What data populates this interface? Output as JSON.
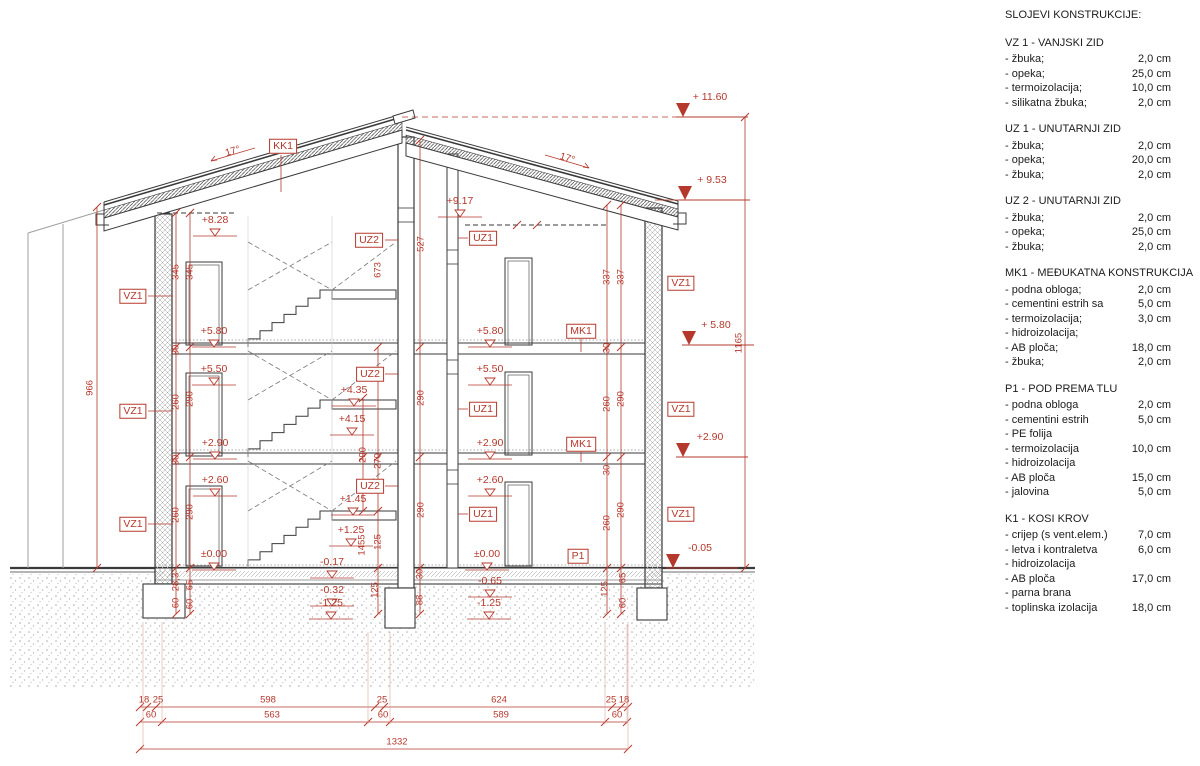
{
  "colors": {
    "accent_red": "#b5382c",
    "line_dark": "#3a3a3a"
  },
  "legend": {
    "title": "SLOJEVI KONSTRUKCIJE:",
    "sections": [
      {
        "heading": "VZ 1 - VANJSKI ZID",
        "items": [
          [
            "- žbuka;",
            "2,0 cm"
          ],
          [
            "- opeka;",
            "25,0 cm"
          ],
          [
            "- termoizolacija;",
            "10,0 cm"
          ],
          [
            "- silikatna žbuka;",
            "2,0 cm"
          ]
        ]
      },
      {
        "heading": "UZ 1 - UNUTARNJI ZID",
        "items": [
          [
            "- žbuka;",
            "2,0 cm"
          ],
          [
            "- opeka;",
            "20,0 cm"
          ],
          [
            "- žbuka;",
            "2,0 cm"
          ]
        ]
      },
      {
        "heading": "UZ 2 - UNUTARNJI ZID",
        "items": [
          [
            "- žbuka;",
            "2,0 cm"
          ],
          [
            "- opeka;",
            "25,0 cm"
          ],
          [
            "- žbuka;",
            "2,0 cm"
          ]
        ]
      },
      {
        "heading": "MK1 - MEĐUKATNA KONSTRUKCIJA",
        "items": [
          [
            "- podna obloga;",
            "2,0 cm"
          ],
          [
            "- cementini estrih sa",
            "5,0 cm"
          ],
          [
            "- termoizolacija;",
            "3,0 cm"
          ],
          [
            "- hidroizolacija;",
            ""
          ],
          [
            "- AB ploča;",
            "18,0 cm"
          ],
          [
            "- žbuka;",
            "2,0 cm"
          ]
        ]
      },
      {
        "heading": "P1 - POD PREMA TLU",
        "items": [
          [
            "- podna obloga",
            "2,0 cm"
          ],
          [
            "- cementini estrih",
            "5,0 cm"
          ],
          [
            "- PE folija",
            ""
          ],
          [
            "- termoizolacija",
            "10,0 cm"
          ],
          [
            "- hidroizolacija",
            ""
          ],
          [
            "- AB ploča",
            "15,0 cm"
          ],
          [
            "- jalovina",
            "5,0 cm"
          ]
        ]
      },
      {
        "heading": "K1 - KOSI KROV",
        "items": [
          [
            "- crijep (s vent.elem.)",
            "7,0 cm"
          ],
          [
            "- letva i kontraletva",
            "6,0 cm"
          ],
          [
            "- hidroizolacija",
            ""
          ],
          [
            "- AB ploča",
            "17,0 cm"
          ],
          [
            "- parna brana",
            ""
          ],
          [
            "- toplinska izolacija",
            "18,0 cm"
          ]
        ]
      }
    ]
  },
  "drawing": {
    "labels": [
      {
        "t": "KK1",
        "x": 283,
        "y": 146,
        "k": "box"
      },
      {
        "t": "UZ2",
        "x": 369,
        "y": 240,
        "k": "box"
      },
      {
        "t": "UZ1",
        "x": 483,
        "y": 238,
        "k": "box"
      },
      {
        "t": "VZ1",
        "x": 133,
        "y": 296,
        "k": "box"
      },
      {
        "t": "VZ1",
        "x": 681,
        "y": 283,
        "k": "box"
      },
      {
        "t": "MK1",
        "x": 581,
        "y": 331,
        "k": "box"
      },
      {
        "t": "UZ2",
        "x": 370,
        "y": 374,
        "k": "box"
      },
      {
        "t": "UZ1",
        "x": 483,
        "y": 409,
        "k": "box"
      },
      {
        "t": "VZ1",
        "x": 133,
        "y": 411,
        "k": "box"
      },
      {
        "t": "VZ1",
        "x": 681,
        "y": 409,
        "k": "box"
      },
      {
        "t": "MK1",
        "x": 581,
        "y": 444,
        "k": "box"
      },
      {
        "t": "UZ2",
        "x": 370,
        "y": 486,
        "k": "box"
      },
      {
        "t": "UZ1",
        "x": 483,
        "y": 514,
        "k": "box"
      },
      {
        "t": "VZ1",
        "x": 133,
        "y": 524,
        "k": "box"
      },
      {
        "t": "VZ1",
        "x": 681,
        "y": 514,
        "k": "box"
      },
      {
        "t": "P1",
        "x": 578,
        "y": 556,
        "k": "box"
      },
      {
        "t": "+8.28",
        "x": 215,
        "y": 220,
        "k": "eo"
      },
      {
        "t": "+9.17",
        "x": 460,
        "y": 201,
        "k": "eo"
      },
      {
        "t": "+5.80",
        "x": 214,
        "y": 331,
        "k": "eo"
      },
      {
        "t": "+5.50",
        "x": 214,
        "y": 369,
        "k": "eo"
      },
      {
        "t": "+2.90",
        "x": 215,
        "y": 443,
        "k": "eo"
      },
      {
        "t": "+2.60",
        "x": 215,
        "y": 480,
        "k": "eo"
      },
      {
        "t": "±0.00",
        "x": 214,
        "y": 554,
        "k": "eo"
      },
      {
        "t": "+5.80",
        "x": 490,
        "y": 331,
        "k": "eo"
      },
      {
        "t": "+5.50",
        "x": 490,
        "y": 369,
        "k": "eo"
      },
      {
        "t": "+2.90",
        "x": 490,
        "y": 443,
        "k": "eo"
      },
      {
        "t": "+2.60",
        "x": 490,
        "y": 480,
        "k": "eo"
      },
      {
        "t": "±0.00",
        "x": 487,
        "y": 554,
        "k": "eo"
      },
      {
        "t": "+4.35",
        "x": 354,
        "y": 390,
        "k": "eo"
      },
      {
        "t": "+4.15",
        "x": 352,
        "y": 419,
        "k": "eo"
      },
      {
        "t": "+1.45",
        "x": 353,
        "y": 499,
        "k": "eo"
      },
      {
        "t": "+1.25",
        "x": 351,
        "y": 530,
        "k": "eo"
      },
      {
        "t": "-0.17",
        "x": 332,
        "y": 562,
        "k": "eo"
      },
      {
        "t": "-0.32",
        "x": 332,
        "y": 590,
        "k": "eo"
      },
      {
        "t": "-1.25",
        "x": 331,
        "y": 603,
        "k": "eo"
      },
      {
        "t": "-0.65",
        "x": 490,
        "y": 581,
        "k": "eo"
      },
      {
        "t": "-1.25",
        "x": 489,
        "y": 603,
        "k": "eo"
      },
      {
        "t": "+ 11.60",
        "x": 710,
        "y": 97,
        "k": "ef"
      },
      {
        "t": "+ 9.53",
        "x": 712,
        "y": 180,
        "k": "ef"
      },
      {
        "t": "+ 5.80",
        "x": 716,
        "y": 325,
        "k": "ef"
      },
      {
        "t": "+2.90",
        "x": 710,
        "y": 437,
        "k": "ef"
      },
      {
        "t": "-0.05",
        "x": 700,
        "y": 548,
        "k": "ef"
      },
      {
        "t": "966",
        "x": 90,
        "y": 388,
        "k": "dv"
      },
      {
        "t": "1165",
        "x": 739,
        "y": 343,
        "k": "dv"
      },
      {
        "t": "345",
        "x": 176,
        "y": 272,
        "k": "dv"
      },
      {
        "t": "345",
        "x": 190,
        "y": 272,
        "k": "dv"
      },
      {
        "t": "260",
        "x": 176,
        "y": 402,
        "k": "dv"
      },
      {
        "t": "290",
        "x": 190,
        "y": 399,
        "k": "dv"
      },
      {
        "t": "260",
        "x": 176,
        "y": 515,
        "k": "dv"
      },
      {
        "t": "290",
        "x": 190,
        "y": 512,
        "k": "dv"
      },
      {
        "t": "30",
        "x": 176,
        "y": 350,
        "k": "dv"
      },
      {
        "t": "30",
        "x": 176,
        "y": 460,
        "k": "dv"
      },
      {
        "t": "28,3",
        "x": 176,
        "y": 582,
        "k": "dv"
      },
      {
        "t": "60",
        "x": 176,
        "y": 603,
        "k": "dv"
      },
      {
        "t": "65",
        "x": 190,
        "y": 585,
        "k": "dv"
      },
      {
        "t": "60",
        "x": 190,
        "y": 604,
        "k": "dv"
      },
      {
        "t": "290",
        "x": 363,
        "y": 455,
        "k": "dv"
      },
      {
        "t": "270",
        "x": 378,
        "y": 461,
        "k": "dv"
      },
      {
        "t": "527",
        "x": 421,
        "y": 244,
        "k": "dv"
      },
      {
        "t": "673",
        "x": 378,
        "y": 270,
        "k": "dv"
      },
      {
        "t": "290",
        "x": 421,
        "y": 398,
        "k": "dv"
      },
      {
        "t": "290",
        "x": 421,
        "y": 510,
        "k": "dv"
      },
      {
        "t": "1455",
        "x": 362,
        "y": 545,
        "k": "dv"
      },
      {
        "t": "125",
        "x": 378,
        "y": 542,
        "k": "dv"
      },
      {
        "t": "125",
        "x": 375,
        "y": 590,
        "k": "dv"
      },
      {
        "t": "88",
        "x": 420,
        "y": 600,
        "k": "dv"
      },
      {
        "t": "30",
        "x": 420,
        "y": 574,
        "k": "dv"
      },
      {
        "t": "337",
        "x": 607,
        "y": 277,
        "k": "dv"
      },
      {
        "t": "337",
        "x": 621,
        "y": 277,
        "k": "dv"
      },
      {
        "t": "260",
        "x": 607,
        "y": 404,
        "k": "dv"
      },
      {
        "t": "290",
        "x": 621,
        "y": 399,
        "k": "dv"
      },
      {
        "t": "260",
        "x": 607,
        "y": 523,
        "k": "dv"
      },
      {
        "t": "290",
        "x": 621,
        "y": 510,
        "k": "dv"
      },
      {
        "t": "30",
        "x": 607,
        "y": 348,
        "k": "dv"
      },
      {
        "t": "30",
        "x": 607,
        "y": 470,
        "k": "dv"
      },
      {
        "t": "65",
        "x": 623,
        "y": 578,
        "k": "dv"
      },
      {
        "t": "60",
        "x": 623,
        "y": 603,
        "k": "dv"
      },
      {
        "t": "125",
        "x": 605,
        "y": 589,
        "k": "dv"
      },
      {
        "t": "18",
        "x": 144,
        "y": 700,
        "k": "dh"
      },
      {
        "t": "25",
        "x": 158,
        "y": 700,
        "k": "dh"
      },
      {
        "t": "598",
        "x": 268,
        "y": 700,
        "k": "dh"
      },
      {
        "t": "25",
        "x": 382,
        "y": 700,
        "k": "dh"
      },
      {
        "t": "624",
        "x": 499,
        "y": 700,
        "k": "dh"
      },
      {
        "t": "25",
        "x": 611,
        "y": 700,
        "k": "dh"
      },
      {
        "t": "18",
        "x": 624,
        "y": 700,
        "k": "dh"
      },
      {
        "t": "60",
        "x": 151,
        "y": 715,
        "k": "dh"
      },
      {
        "t": "563",
        "x": 272,
        "y": 715,
        "k": "dh"
      },
      {
        "t": "60",
        "x": 383,
        "y": 715,
        "k": "dh"
      },
      {
        "t": "589",
        "x": 501,
        "y": 715,
        "k": "dh"
      },
      {
        "t": "60",
        "x": 617,
        "y": 715,
        "k": "dh"
      },
      {
        "t": "1332",
        "x": 397,
        "y": 742,
        "k": "dh"
      },
      {
        "t": "17°",
        "x": 233,
        "y": 152,
        "k": "al"
      },
      {
        "t": "17°",
        "x": 567,
        "y": 159,
        "k": "ar"
      }
    ]
  }
}
